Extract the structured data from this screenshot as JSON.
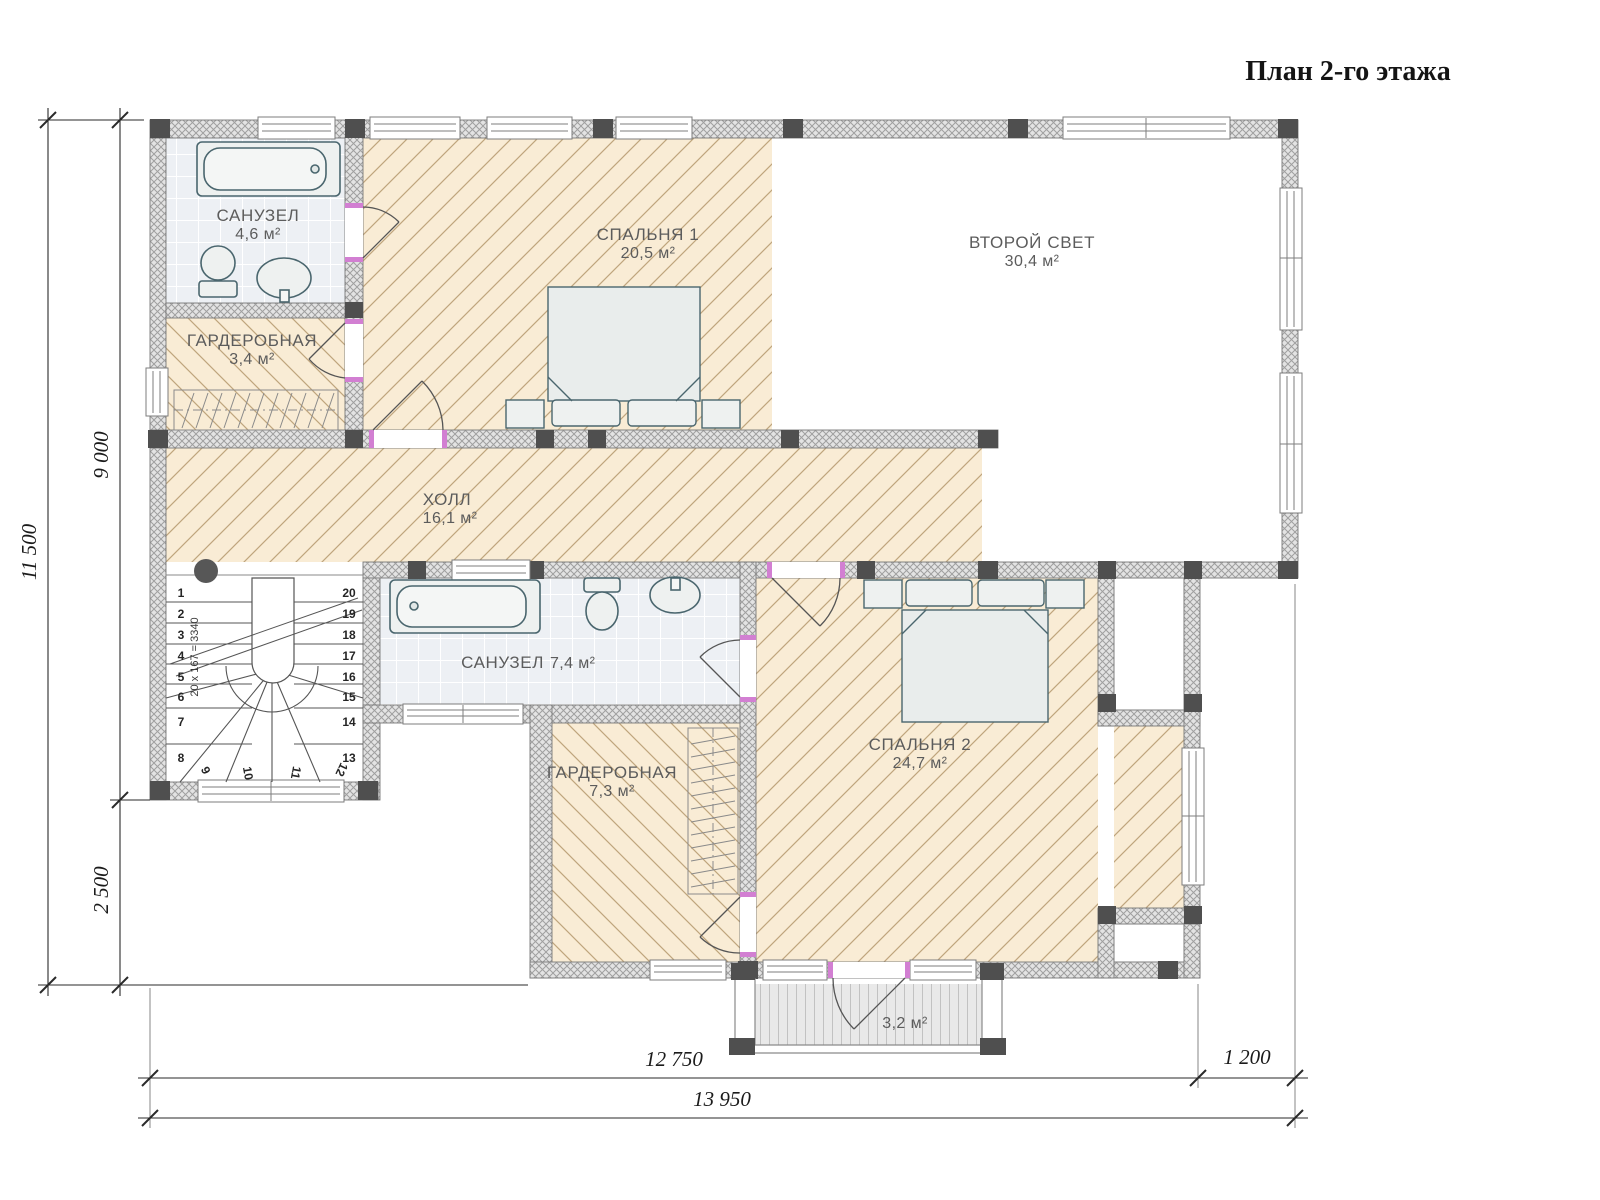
{
  "title": "План 2-го этажа",
  "rooms": {
    "sanuzel1": {
      "name": "САНУЗЕЛ",
      "area": "4,6 м²"
    },
    "garderobnaya1": {
      "name": "ГАРДЕРОБНАЯ",
      "area": "3,4 м²"
    },
    "spalnya1": {
      "name": "СПАЛЬНЯ 1",
      "area": "20,5 м²"
    },
    "vtoroy_svet": {
      "name": "ВТОРОЙ СВЕТ",
      "area": "30,4 м²"
    },
    "holl": {
      "name": "ХОЛЛ",
      "area": "16,1 м²"
    },
    "sanuzel2": {
      "name": "САНУЗЕЛ",
      "area": "7,4 м²"
    },
    "spalnya2": {
      "name": "СПАЛЬНЯ 2",
      "area": "24,7 м²"
    },
    "garderobnaya2": {
      "name": "ГАРДЕРОБНАЯ",
      "area": "7,3 м²"
    },
    "balcony": {
      "area": "3,2 м²"
    }
  },
  "stairs": {
    "formula": "20 х 167 = 3340",
    "numbers": [
      "1",
      "2",
      "3",
      "4",
      "5",
      "6",
      "7",
      "8",
      "9",
      "10",
      "11",
      "12",
      "13",
      "14",
      "15",
      "16",
      "17",
      "18",
      "19",
      "20"
    ]
  },
  "dimensions": {
    "left_total": "11 500",
    "left_upper": "9 000",
    "left_lower": "2 500",
    "bottom_left": "12 750",
    "bottom_right": "1 200",
    "bottom_total": "13 950"
  },
  "colors": {
    "floor_beige": "#f9ecd5",
    "floor_hatch": "#bfa57d",
    "wall_fill": "#e3e3e3",
    "wall_hatch": "#9f9f9f",
    "column": "#4f4f4f",
    "tile_floor": "#edf0f4",
    "fixture_stroke": "#4a666e",
    "door_mark": "#d27fd2"
  }
}
